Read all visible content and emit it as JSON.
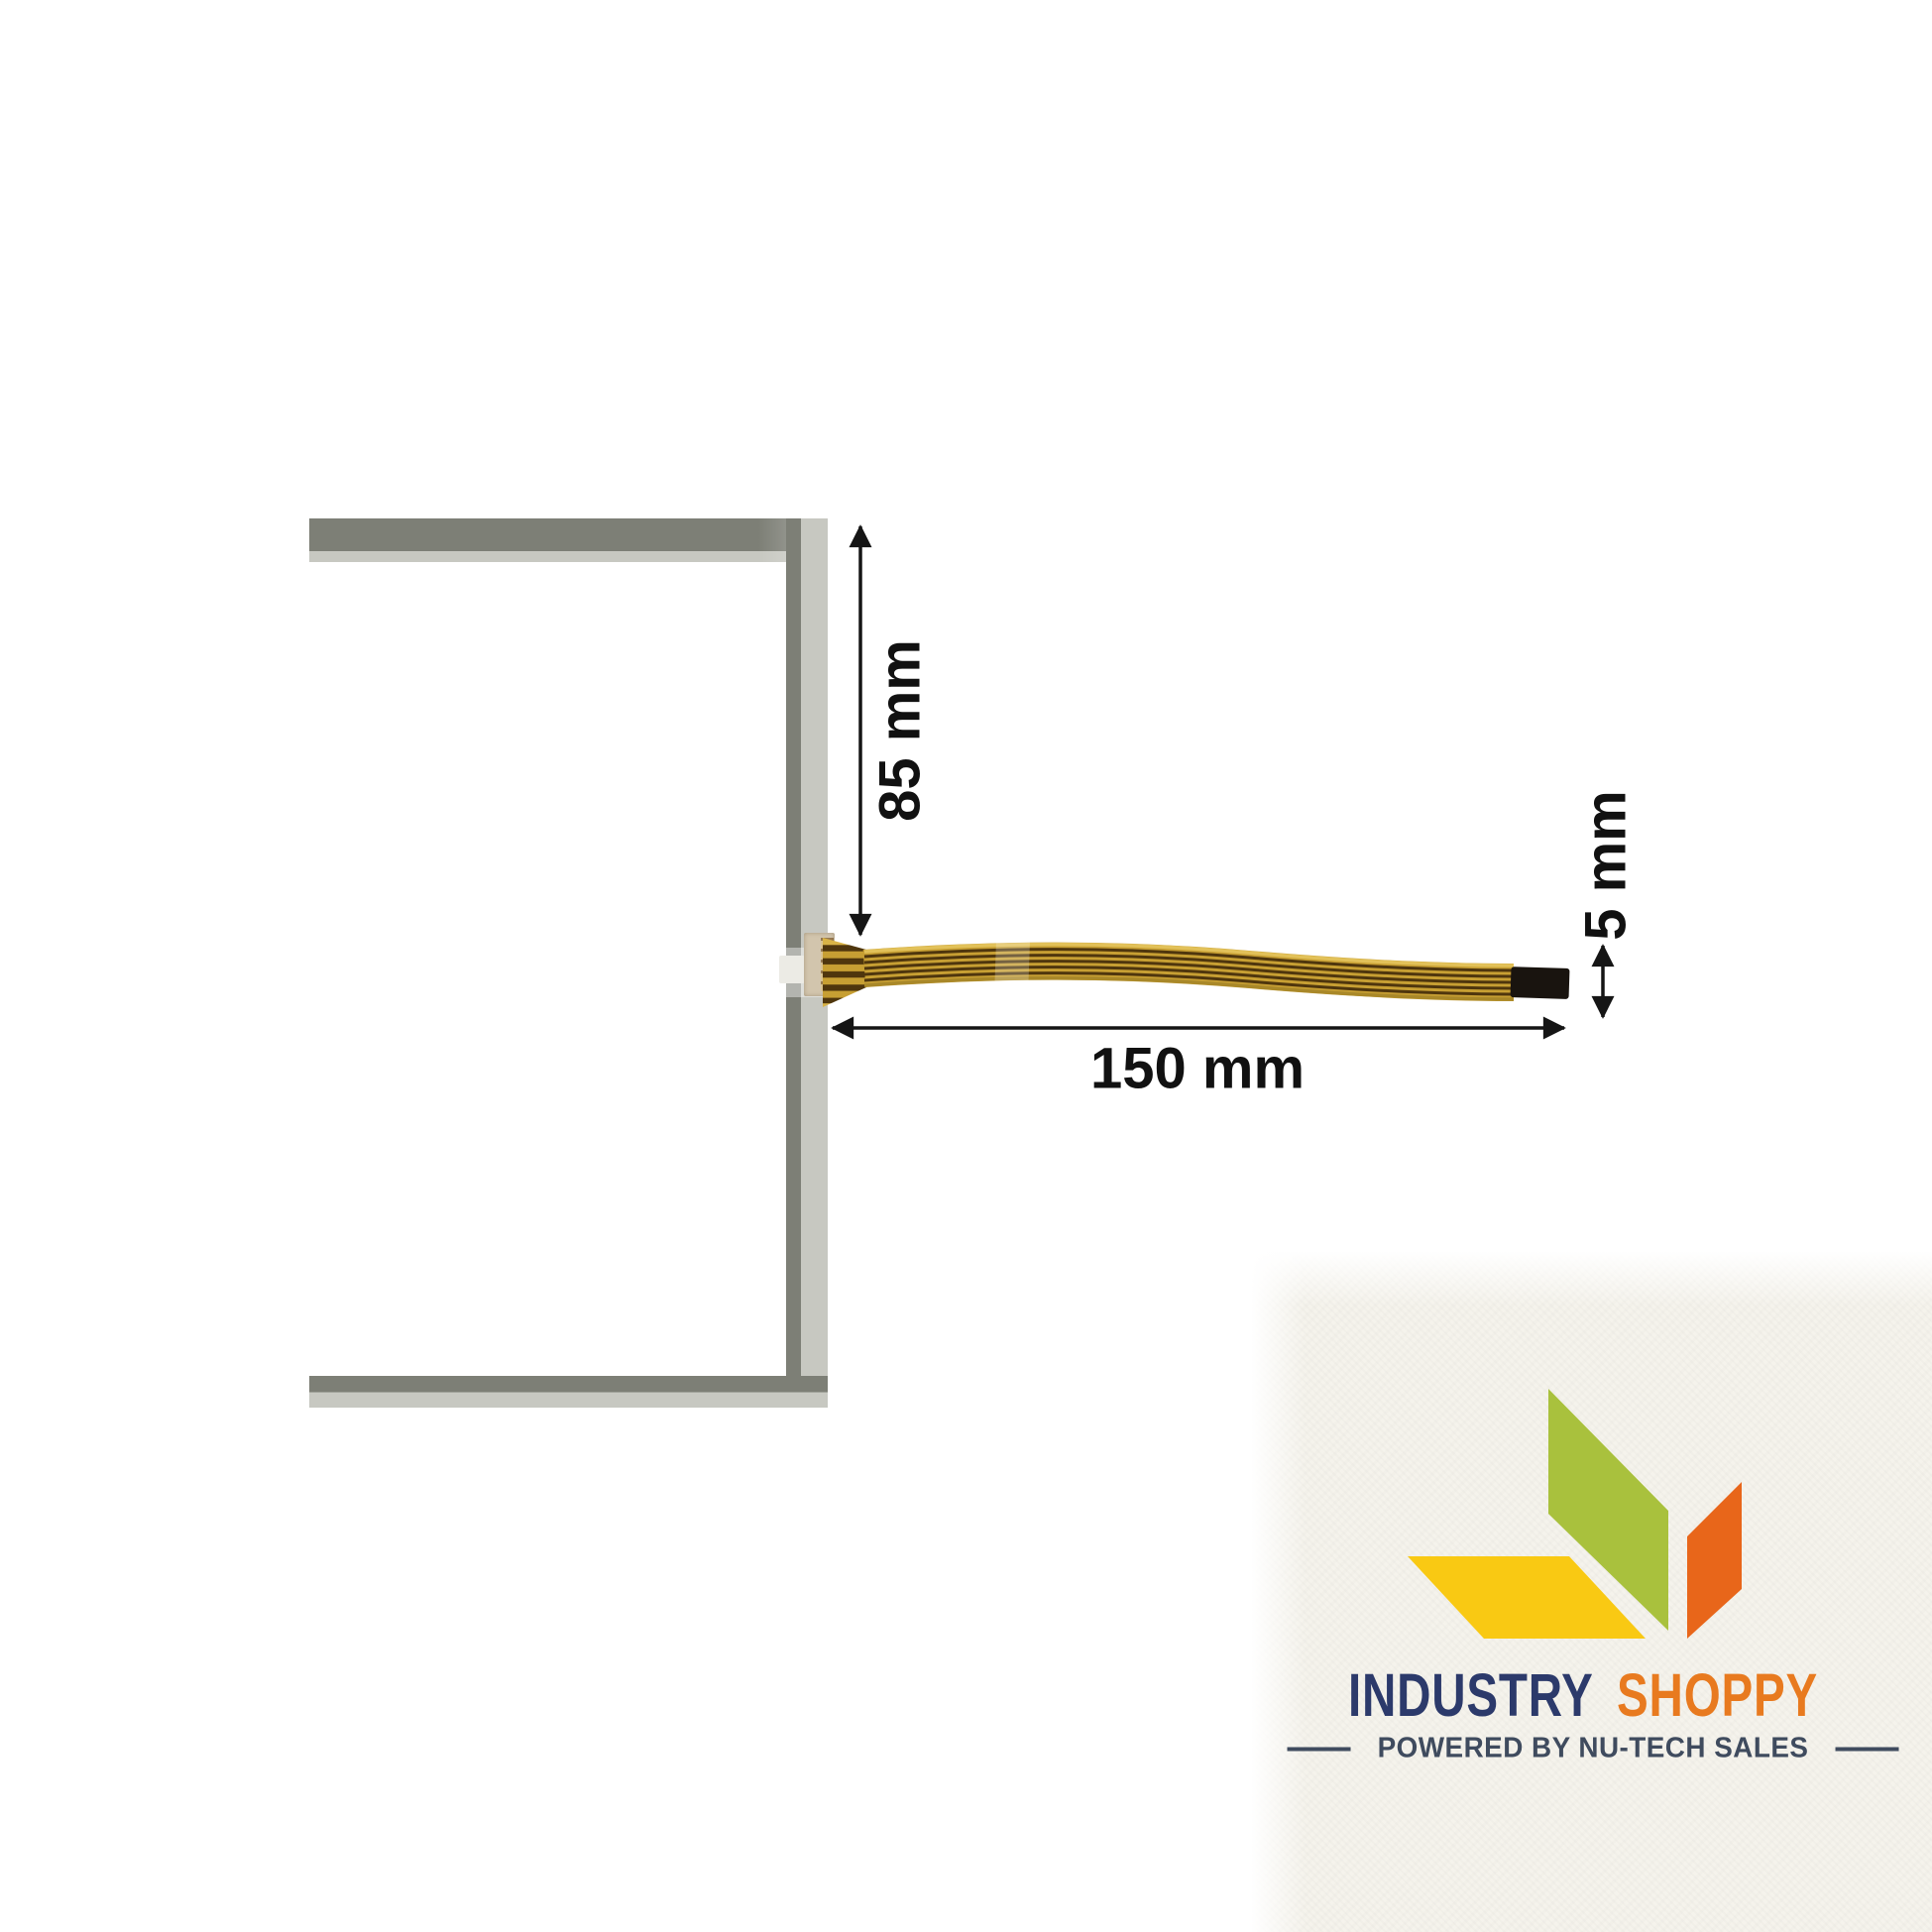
{
  "diagram": {
    "dimension_height_label": "85 mm",
    "dimension_length_label": "150 mm",
    "dimension_cable_width_label": "5 mm"
  },
  "logo": {
    "brand_word_1": "INDUSTRY",
    "brand_word_2": "SHOPPY",
    "tagline": "POWERED BY NU-TECH SALES"
  },
  "colors": {
    "panel-dark": "#7d7f76",
    "panel-light": "#c7c8c1",
    "connector-tan": "#d2c5ad",
    "cable-gold": "#c79f33",
    "cable-gold-light": "#e2c159",
    "cable-gold-dark": "#a98829",
    "cable-stripe": "#4f360d",
    "cable-tip": "#19140f",
    "dim-line": "#151515",
    "paper-cream": "#f5f3ec",
    "leaf-green": "#a9c13d",
    "leaf-yellow": "#f9c913",
    "leaf-orange": "#e8661a",
    "brand-navy": "#2c3a6b",
    "brand-orange": "#e87a1f",
    "tagline-color": "#3f4b5e"
  }
}
